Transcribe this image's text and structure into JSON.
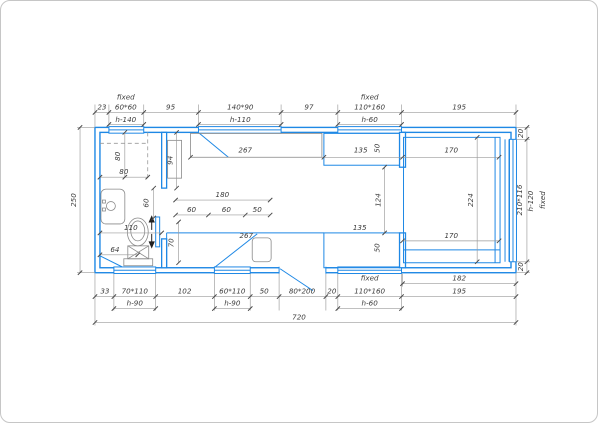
{
  "drawing": {
    "kind": "floor-plan",
    "wall_color": "#1e88e5",
    "dimension_color": "#9a9a9a",
    "text_color": "#3c3c3c",
    "labels": {
      "top": {
        "fixed_l": "fixed",
        "n23": "23",
        "w60x60": "60*60",
        "n95": "95",
        "w140x90": "140*90",
        "n97": "97",
        "fixed_r": "fixed",
        "w110x160": "110*160",
        "n195": "195",
        "h140": "h-140",
        "h110": "h-110",
        "h60": "h-60"
      },
      "bottom": {
        "n182": "182",
        "n33": "33",
        "w70x110": "70*110",
        "n102": "102",
        "w60x110": "60*110",
        "n50": "50",
        "d80x200": "80*200",
        "n20": "20",
        "fixed": "fixed",
        "w110x160": "110*160",
        "n195": "195",
        "h90a": "h-90",
        "h90b": "h-90",
        "h60": "h-60",
        "total": "720"
      },
      "left": {
        "n250": "250"
      },
      "right": {
        "n20t": "20",
        "w210x116": "210*116",
        "h120": "h-120",
        "fixed": "fixed",
        "n20b": "20"
      },
      "interior": {
        "counterTop": "267",
        "c135t": "135",
        "c50t": "50",
        "bed170t": "170",
        "v80": "80",
        "h80": "80",
        "n94": "94",
        "slide60": "60",
        "k180": "180",
        "k60a": "60",
        "k60b": "60",
        "k50": "50",
        "n124": "124",
        "n224": "224",
        "toilet110": "110",
        "toilet64": "64",
        "n70": "70",
        "counterBot": "267",
        "c135b": "135",
        "c50b": "50",
        "bed170b": "170"
      }
    }
  }
}
